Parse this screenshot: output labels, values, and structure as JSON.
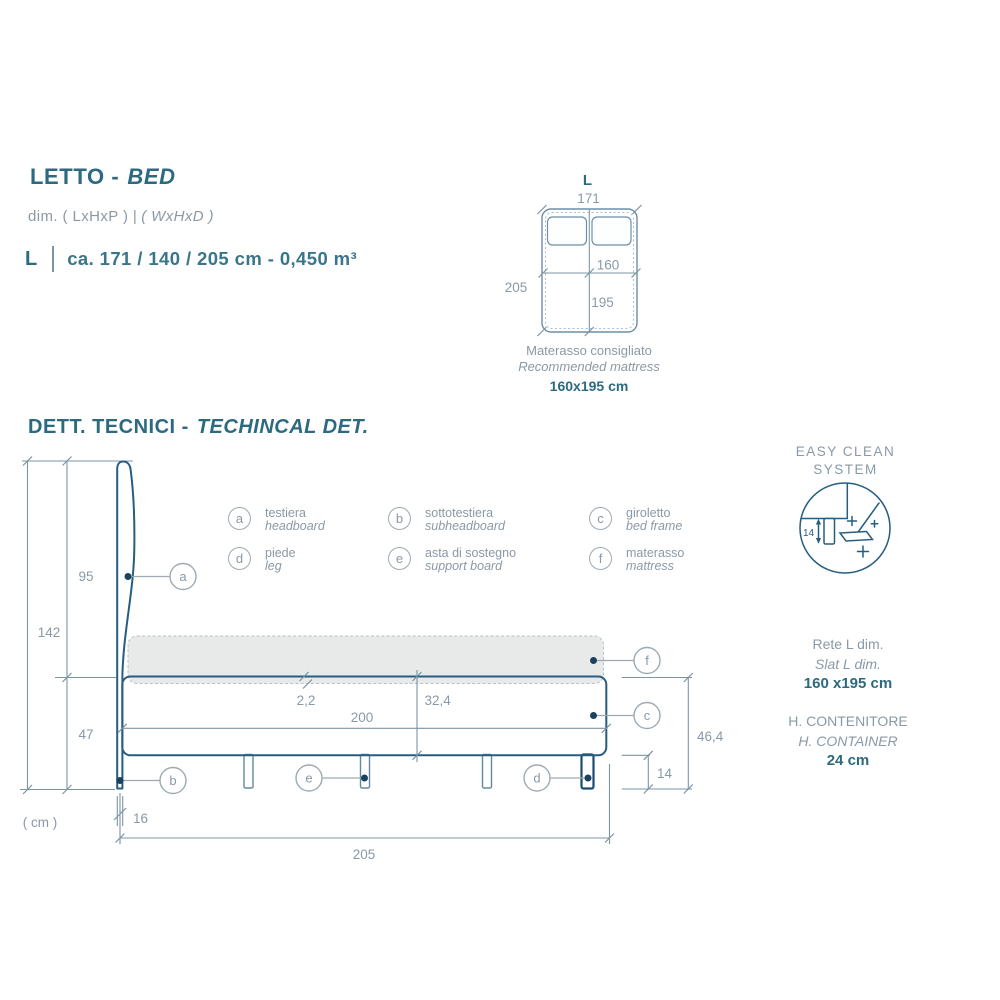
{
  "header": {
    "title_it": "LETTO -",
    "title_en": "BED",
    "dims_note_plain": "dim. ( LxHxP ) |",
    "dims_note_italic": "( WxHxD )",
    "spec_size": "L",
    "spec_value": "ca. 171 / 140 / 205 cm - 0,450 m³"
  },
  "top_view": {
    "label": "L",
    "width": "171",
    "length": "205",
    "mattress_width": "160",
    "mattress_length": "195",
    "caption_it": "Materasso consigliato",
    "caption_en": "Recommended mattress",
    "caption_size": "160x195 cm"
  },
  "section": {
    "title_it": "DETT. TECNICI -",
    "title_en": "TECHINCAL DET."
  },
  "legend": {
    "items": [
      {
        "letter": "a",
        "it": "testiera",
        "en": "headboard"
      },
      {
        "letter": "b",
        "it": "sottotestiera",
        "en": "subheadboard"
      },
      {
        "letter": "c",
        "it": "giroletto",
        "en": "bed frame"
      },
      {
        "letter": "d",
        "it": "piede",
        "en": "leg"
      },
      {
        "letter": "e",
        "it": "asta di sostegno",
        "en": "support board"
      },
      {
        "letter": "f",
        "it": "materasso",
        "en": "mattress"
      }
    ]
  },
  "drawing": {
    "total_height": "142",
    "headboard_height": "95",
    "base_height": "47",
    "unit": "( cm )",
    "hb_thickness": "16",
    "total_length": "205",
    "inner_length": "200",
    "slat_thickness": "2,2",
    "frame_height": "32,4",
    "overall_base_height": "46,4",
    "leg_height": "14",
    "labels": {
      "a": "a",
      "b": "b",
      "c": "c",
      "d": "d",
      "e": "e",
      "f": "f"
    }
  },
  "easy_clean": {
    "title_line1": "EASY CLEAN",
    "title_line2": "SYSTEM",
    "leg_clearance": "14"
  },
  "info": {
    "slat_it": "Rete L dim.",
    "slat_en": "Slat L dim.",
    "slat_value": "160 x195 cm",
    "container_it": "H. CONTENITORE",
    "container_en": "H. CONTAINER",
    "container_value": "24 cm"
  },
  "colors": {
    "accent": "#2c6a80",
    "muted": "#8a99a6",
    "line_dark": "#275d80",
    "line_light": "#7b94a6",
    "mattress_fill": "#e8e9e9"
  }
}
